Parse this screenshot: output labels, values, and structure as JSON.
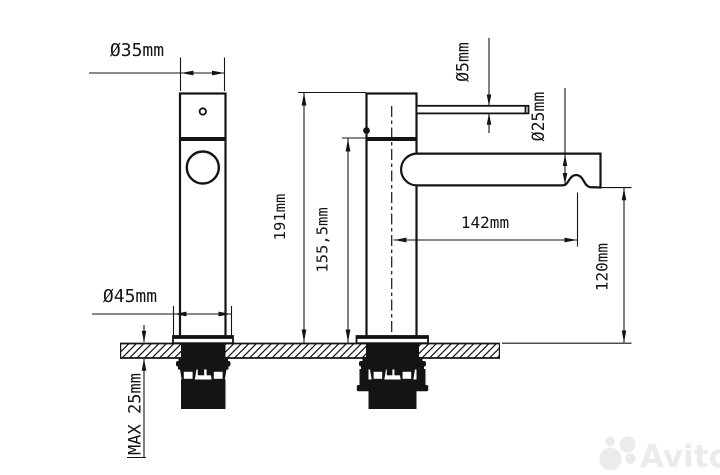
{
  "drawing": {
    "title": "faucet-installation-dimension-drawing",
    "labels": {
      "dia35": "Ø35mm",
      "dia45": "Ø45mm",
      "h191": "191mm",
      "h1555": "155,5mm",
      "dia5": "Ø5mm",
      "dia25": "Ø25mm",
      "w142": "142mm",
      "h120": "120mm",
      "max25": "MAX 25mm"
    },
    "colors": {
      "line": "#141414",
      "background": "#ffffff",
      "watermark": "#ebebeb"
    }
  },
  "watermark": {
    "brand": "Avito"
  }
}
